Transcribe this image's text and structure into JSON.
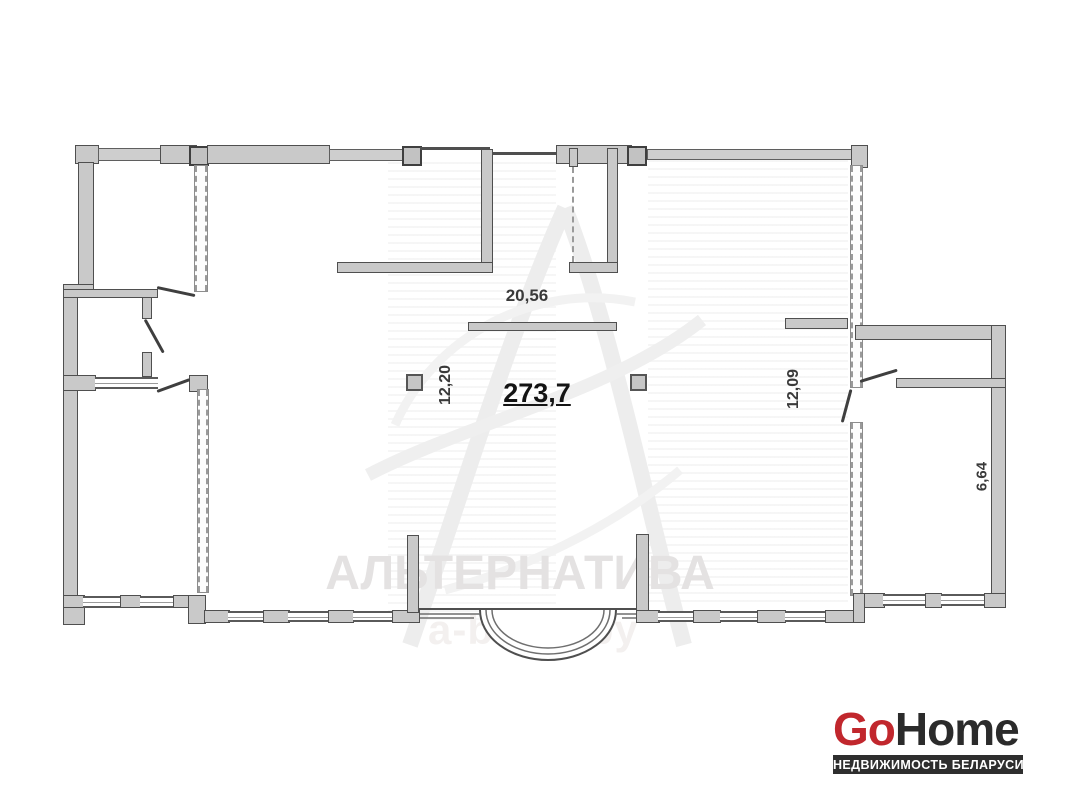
{
  "plan": {
    "area_total": "273,7",
    "dim_width_top": "20,56",
    "dim_left": "12,20",
    "dim_right": "12,09",
    "dim_annex_room": "6,64"
  },
  "watermark": {
    "brand": "АЛЬТЕРНАТИВА",
    "site": "a-brest.by"
  },
  "logo": {
    "go": "Go",
    "home": "Home",
    "tagline": "НЕДВИЖИМОСТЬ БЕЛАРУСИ"
  },
  "colors": {
    "logo_red": "#c1272d",
    "logo_dark": "#2b2b2b",
    "banner_bg": "#2e2e2e",
    "wall_fill": "#c9c9c9",
    "wall_outline": "#4f4f4f",
    "dashed_wall": "#9a9a9a",
    "watermark_text": "#e4e2e2",
    "watermark_site": "#f3f0ef",
    "dim_text": "#3a3a3a"
  }
}
